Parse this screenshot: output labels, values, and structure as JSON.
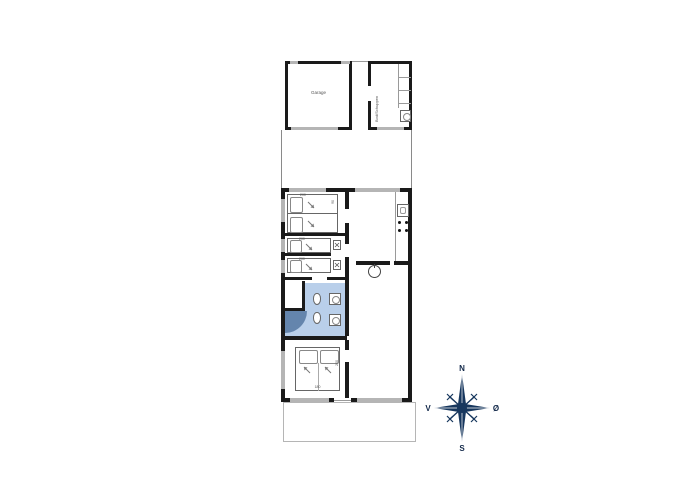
{
  "floorplan": {
    "garage": {
      "label": "Garage"
    },
    "shed": {
      "label": "Bod/Schuppen"
    },
    "beds": {
      "bedroom1_length": "200",
      "bedroom1_width": "90",
      "bedroom2_length": "200",
      "bedroom3_length": "200",
      "bedroom4_length": "200",
      "bedroom4_width": "180"
    },
    "compass": {
      "n": "N",
      "s": "S",
      "w": "V",
      "e": "Ø"
    },
    "colors": {
      "wall": "#1a1a1a",
      "window": "#b5b5b5",
      "bath": "#b9cfea",
      "shower": "#6485ad",
      "compass": "#17375e"
    }
  }
}
